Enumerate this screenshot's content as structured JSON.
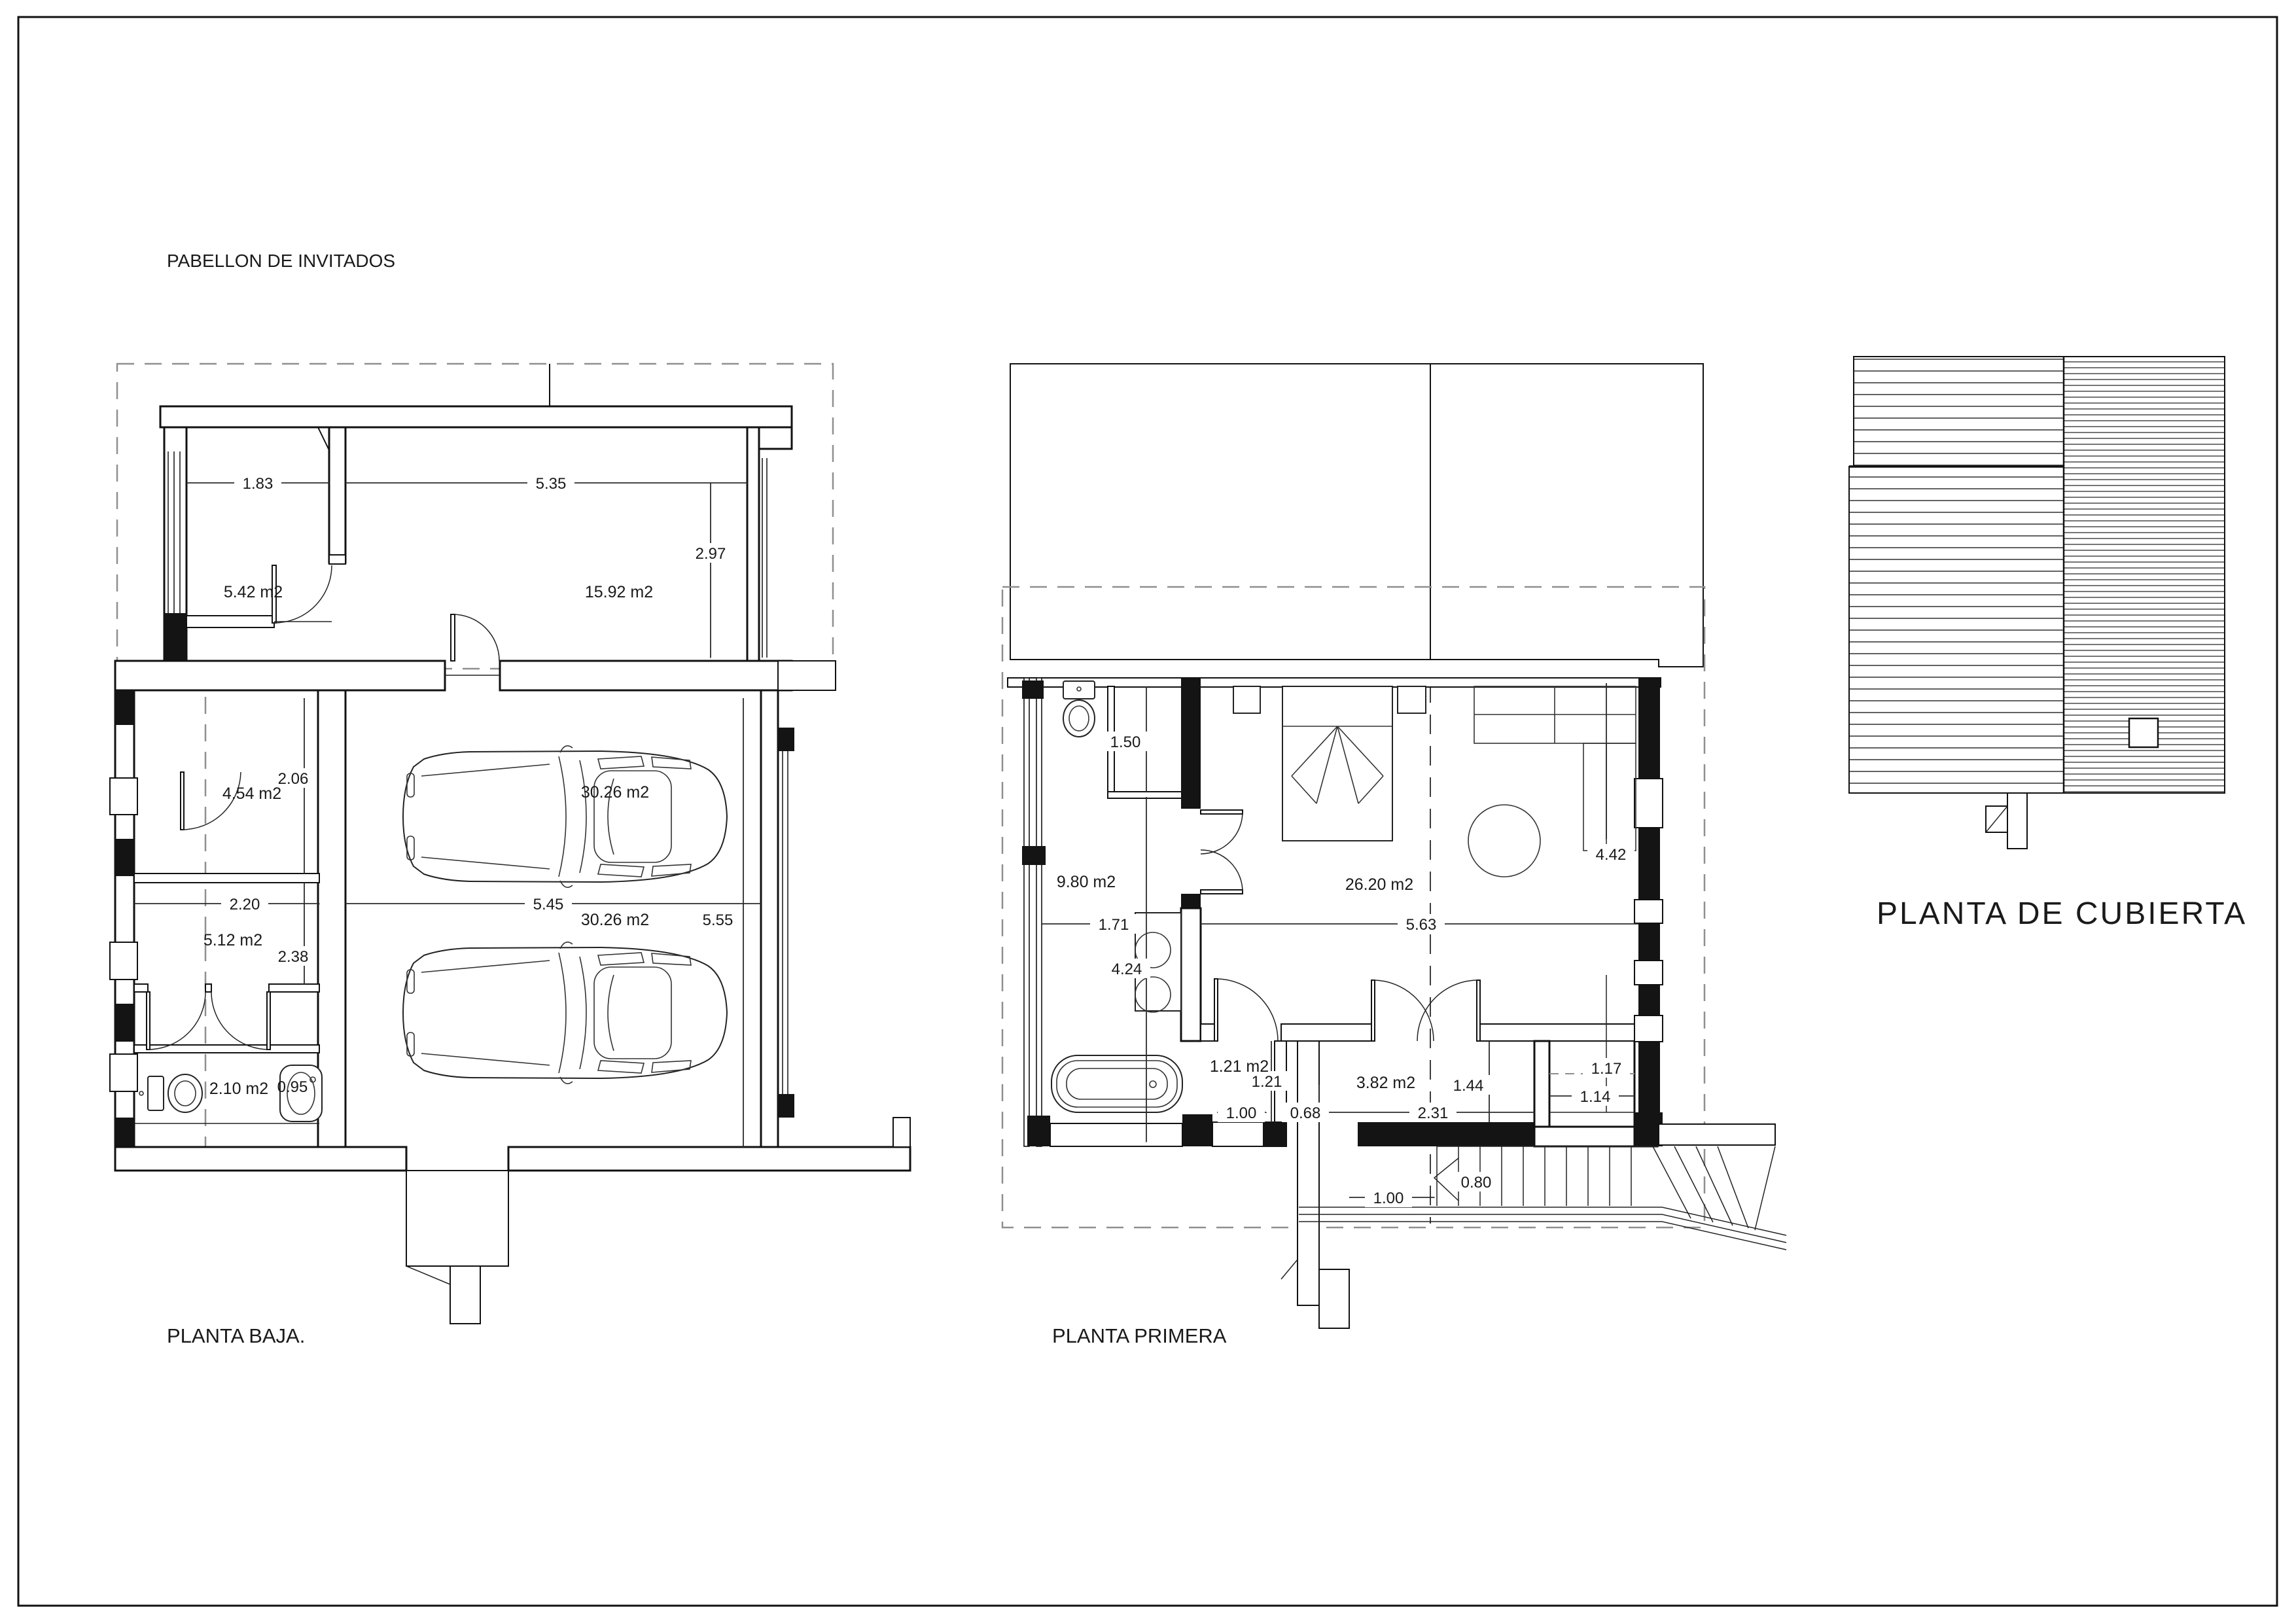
{
  "title": "PABELLON DE INVITADOS",
  "ground": {
    "label": "PLANTA BAJA.",
    "areas": [
      "5.42 m2",
      "15.92 m2",
      "4.54 m2",
      "30.26 m2",
      "30.26 m2",
      "5.12 m2",
      "2.10 m2"
    ],
    "dims": [
      "1.83",
      "5.35",
      "2.97",
      "2.06",
      "2.20",
      "5.45",
      "5.55",
      "2.38",
      "0.95"
    ]
  },
  "first": {
    "label": "PLANTA PRIMERA",
    "areas": [
      "9.80 m2",
      "26.20 m2",
      "1.21 m2",
      "3.82 m2"
    ],
    "dims": [
      "1.50",
      "1.71",
      "4.24",
      "5.63",
      "4.42",
      "1.21",
      "1.00",
      "0.68",
      "2.31",
      "1.44",
      "1.17",
      "1.14",
      "0.80",
      "1.00"
    ]
  },
  "roof": {
    "label": "PLANTA DE CUBIERTA"
  },
  "colors": {
    "line": "#111111",
    "dim": "#2b2b2b",
    "dashed_gray": "#8f8f8f",
    "paper": "#ffffff"
  }
}
